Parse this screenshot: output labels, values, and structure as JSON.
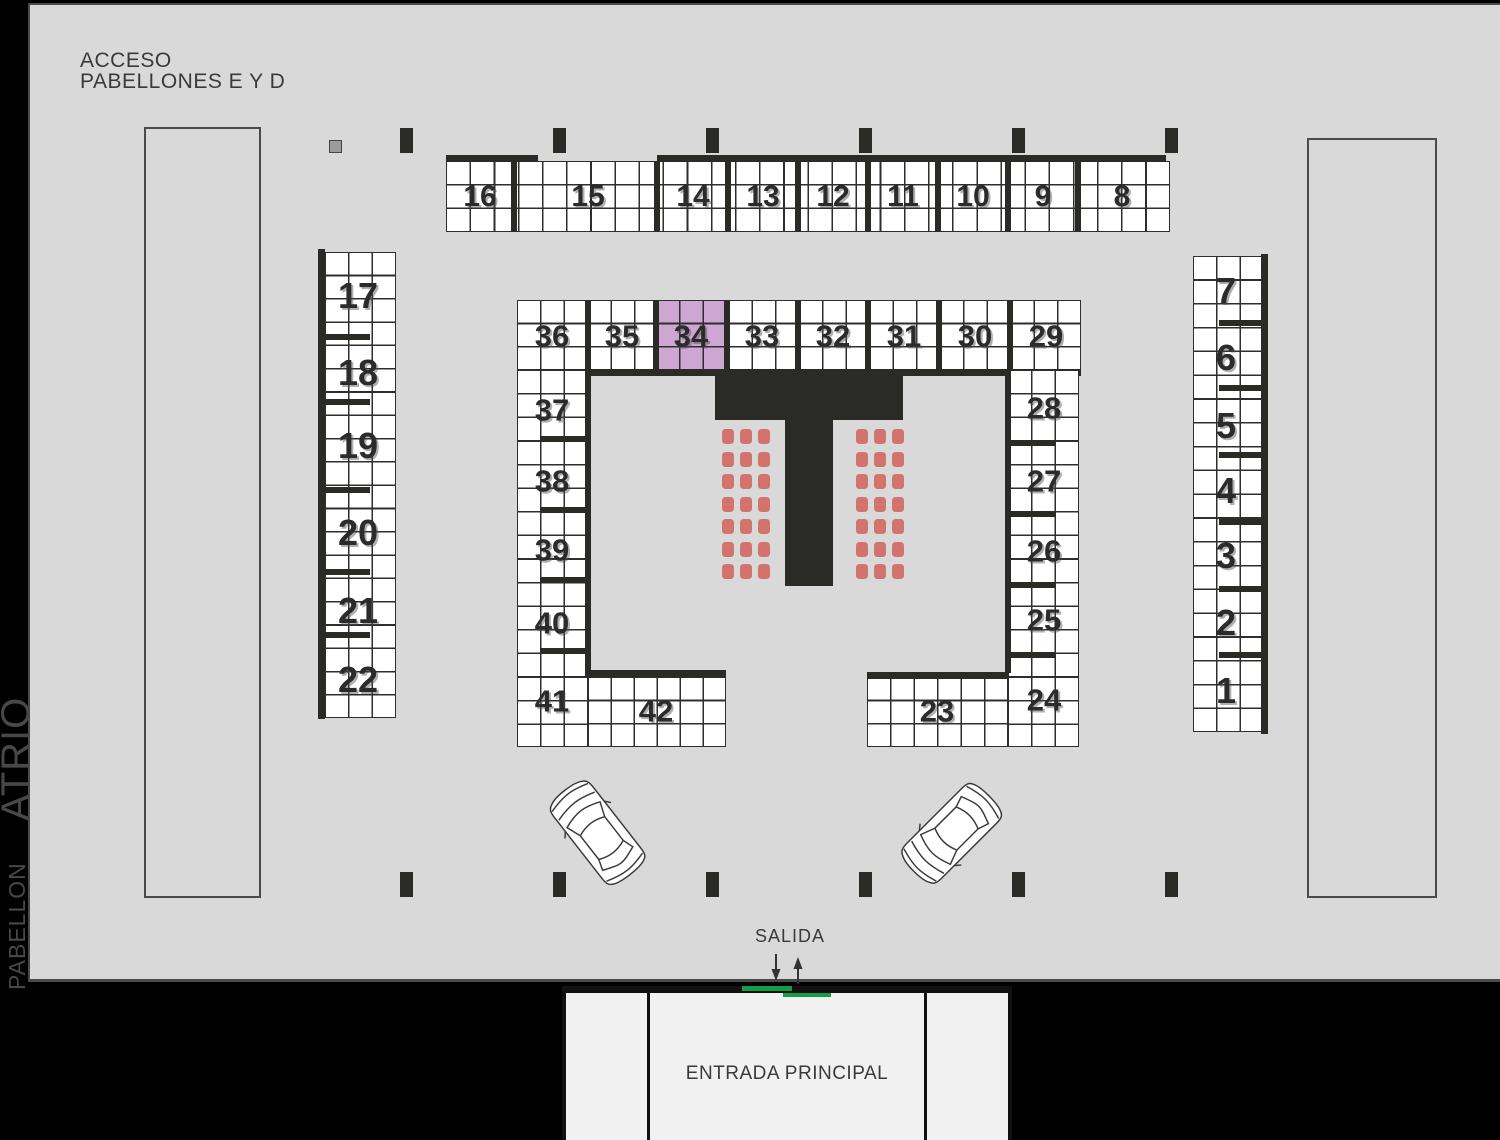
{
  "labels": {
    "acceso_line1": "ACCESO",
    "acceso_line2": "PABELLONES E Y D",
    "pabellon_vertical": "PABELLON",
    "atrio_vertical": "ATRIO",
    "salida": "SALIDA",
    "entrada": "ENTRADA PRINCIPAL"
  },
  "booths": {
    "outer_top": [
      "16",
      "15",
      "14",
      "13",
      "12",
      "11",
      "10",
      "9",
      "8"
    ],
    "outer_left": [
      "17",
      "18",
      "19",
      "20",
      "21",
      "22"
    ],
    "outer_right": [
      "7",
      "6",
      "5",
      "4",
      "3",
      "2",
      "1"
    ],
    "inner_top": [
      "36",
      "35",
      "34",
      "33",
      "32",
      "31",
      "30",
      "29"
    ],
    "inner_left": [
      "37",
      "38",
      "39",
      "40",
      "41"
    ],
    "inner_right": [
      "28",
      "27",
      "26",
      "25",
      "24"
    ],
    "bottom_center_left": [
      "42"
    ],
    "bottom_center_right": [
      "23"
    ]
  },
  "selected_booth": "34",
  "stage_seating": {
    "chair_groups": 2,
    "rows_per_group": 7,
    "chairs_per_row": 3
  },
  "colors": {
    "floor": "#d8d9d8",
    "margin": "#000000",
    "structure": "#2a2a27",
    "grid_line": "#2e2e2e",
    "booth_fill": "#ffffff",
    "highlight": "#cda7d2",
    "chair": "#d2736e",
    "exit_marker_green": "#169c46",
    "zone_border": "#4a4a4a",
    "building_panel": "#f1f1f1",
    "text": "#3a3a3a"
  }
}
